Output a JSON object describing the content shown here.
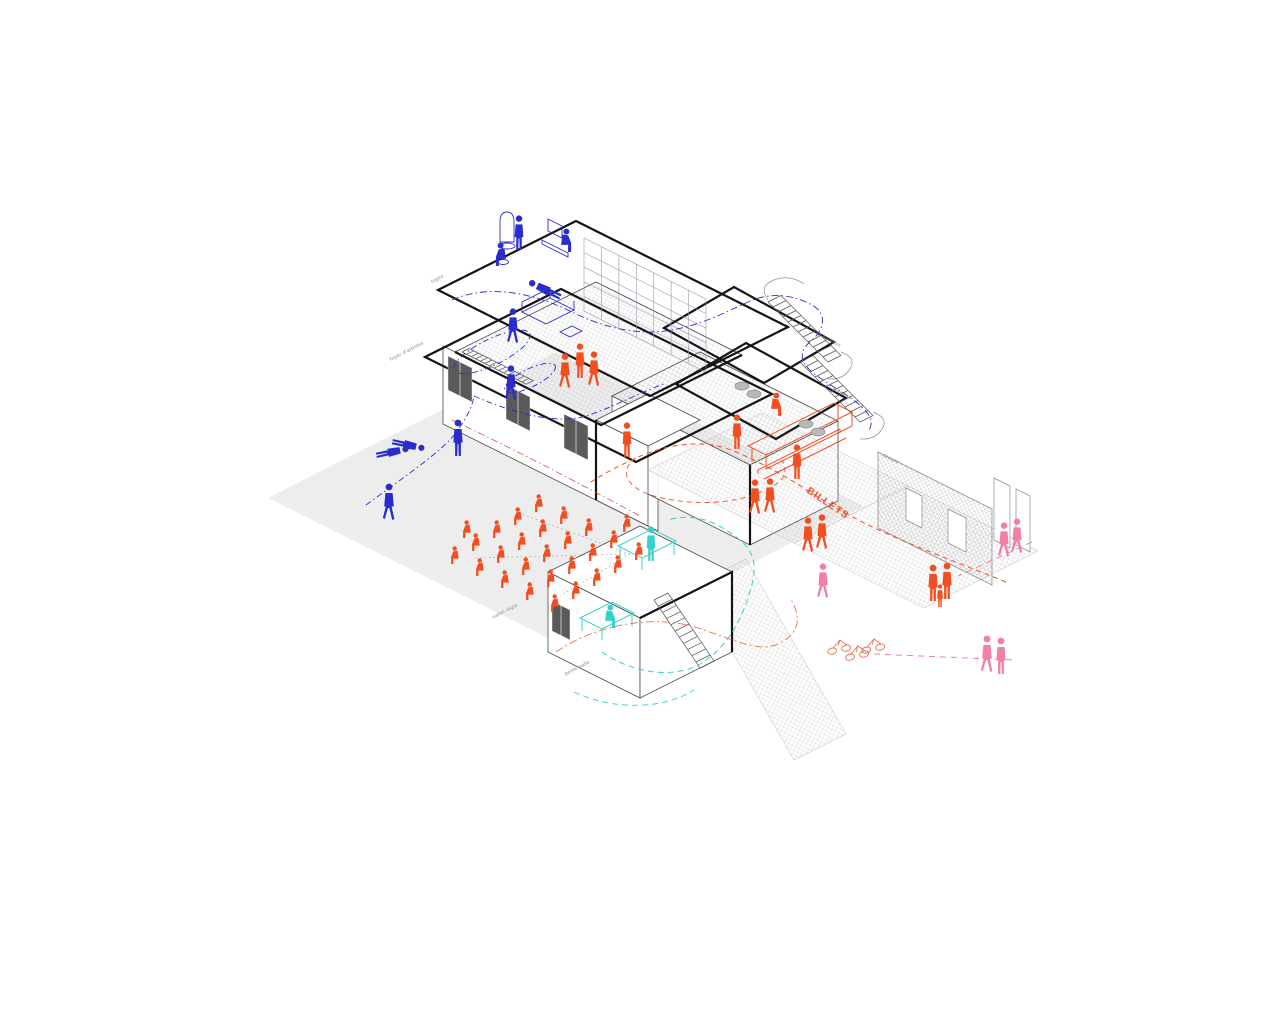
{
  "title": "axonometric circulation diagram of a performance venue",
  "colors": {
    "blue": "#2a2ccd",
    "orange": "#f24e20",
    "orange2": "#e8744f",
    "cyan": "#35d1cd",
    "pink": "#f37fa2",
    "grey_ground": "#ececec",
    "line": "#3c3c3c",
    "thick": "#141414",
    "hatch": "#b9b9b9",
    "label": "#8a8a8a",
    "red": "#e0503a",
    "sight": "#9a9a9a",
    "pouf_fill": "#b9b9b9",
    "pouf_stroke": "#8a8a8a",
    "door_fill": "#5a5a5a"
  },
  "labels": [
    {
      "text": "loges",
      "x": 444,
      "y": 277,
      "rot": -27
    },
    {
      "text": "foyer d'artistes",
      "x": 424,
      "y": 344,
      "rot": -27
    },
    {
      "text": "+2 bureaux",
      "x": 840,
      "y": 347,
      "rot": 27
    },
    {
      "text": "+1 bureaux",
      "x": 850,
      "y": 399,
      "rot": 27
    },
    {
      "text": "accueil",
      "x": 898,
      "y": 464,
      "rot": 27
    },
    {
      "text": "salon régie",
      "x": 518,
      "y": 606,
      "rot": -27
    },
    {
      "text": "petite salle",
      "x": 590,
      "y": 663,
      "rot": -27
    }
  ],
  "billets_label": {
    "text": "BILLETS",
    "x": 806,
    "y": 492,
    "rot": 34,
    "color": "#f24e20"
  },
  "figures": [
    {
      "t": "stand",
      "c": "blue",
      "x": 519,
      "y": 250,
      "s": 0.95
    },
    {
      "t": "sit",
      "c": "blue",
      "x": 562,
      "y": 252,
      "s": 0.95,
      "flip": true
    },
    {
      "t": "sit",
      "c": "blue",
      "x": 505,
      "y": 266,
      "s": 0.95
    },
    {
      "t": "lie",
      "c": "blue",
      "x": 546,
      "y": 306,
      "s": 0.95,
      "rot": -64
    },
    {
      "t": "walk",
      "c": "blue",
      "x": 513,
      "y": 343,
      "s": 0.95
    },
    {
      "t": "walk",
      "c": "blue",
      "x": 511,
      "y": 400,
      "s": 0.95
    },
    {
      "t": "stand",
      "c": "blue",
      "x": 458,
      "y": 456,
      "s": 1
    },
    {
      "t": "lie",
      "c": "blue",
      "x": 392,
      "y": 468,
      "s": 0.9,
      "rot": 78
    },
    {
      "t": "lie",
      "c": "blue",
      "x": 408,
      "y": 461,
      "s": 0.9,
      "rot": 102
    },
    {
      "t": "walk",
      "c": "blue",
      "x": 389,
      "y": 520,
      "s": 1
    },
    {
      "t": "walk",
      "c": "orange",
      "x": 565,
      "y": 388,
      "s": 0.95
    },
    {
      "t": "stand",
      "c": "orange",
      "x": 580,
      "y": 378,
      "s": 0.95
    },
    {
      "t": "walk",
      "c": "orange",
      "x": 594,
      "y": 386,
      "s": 0.95
    },
    {
      "t": "stand",
      "c": "orange",
      "x": 737,
      "y": 449,
      "s": 0.95
    },
    {
      "t": "stand",
      "c": "orange",
      "x": 627,
      "y": 457,
      "s": 0.95
    },
    {
      "t": "walk",
      "c": "orange",
      "x": 755,
      "y": 514,
      "s": 0.95
    },
    {
      "t": "walk",
      "c": "orange",
      "x": 770,
      "y": 513,
      "s": 0.95
    },
    {
      "t": "stand",
      "c": "orange",
      "x": 797,
      "y": 479,
      "s": 0.95
    },
    {
      "t": "sit",
      "c": "orange",
      "x": 772,
      "y": 416,
      "s": 0.95,
      "flip": true
    },
    {
      "t": "walk",
      "c": "orange",
      "x": 808,
      "y": 552,
      "s": 0.95
    },
    {
      "t": "walk",
      "c": "orange",
      "x": 822,
      "y": 549,
      "s": 0.95
    },
    {
      "t": "stand",
      "c": "orange",
      "x": 933,
      "y": 601,
      "s": 1
    },
    {
      "t": "stand",
      "c": "orange",
      "x": 947,
      "y": 599,
      "s": 1
    },
    {
      "t": "stand",
      "c": "orange",
      "x": 940,
      "y": 607,
      "s": 0.62
    },
    {
      "t": "stand",
      "c": "cyan",
      "x": 651,
      "y": 561,
      "s": 0.95
    },
    {
      "t": "sit",
      "c": "cyan",
      "x": 606,
      "y": 628,
      "s": 0.95,
      "flip": true
    },
    {
      "t": "walk",
      "c": "pink",
      "x": 1004,
      "y": 557,
      "s": 0.95
    },
    {
      "t": "walk",
      "c": "pink",
      "x": 1017,
      "y": 553,
      "s": 0.95
    },
    {
      "t": "walk",
      "c": "pink",
      "x": 823,
      "y": 598,
      "s": 0.95
    },
    {
      "t": "walk",
      "c": "pink",
      "x": 987,
      "y": 672,
      "s": 1
    },
    {
      "t": "stand",
      "c": "pink",
      "x": 1001,
      "y": 674,
      "s": 1
    }
  ],
  "audience": {
    "color": "orange",
    "origin": [
      542,
      512
    ],
    "col_step": [
      25,
      12
    ],
    "row_step": [
      -21,
      13
    ],
    "rows": 5,
    "cols": 5,
    "scale": 0.72,
    "extras": [
      [
        470,
        538
      ],
      [
        630,
        532
      ]
    ]
  },
  "paths": [
    {
      "c": "blue",
      "w": 0.9,
      "dash": "7 3 1.5 3",
      "d": "M 452,300 C 492,282 540,296 572,312 S 640,336 672,330 S 726,312 748,302 S 792,294 812,305 C 828,314 824,330 812,340 S 798,360 812,372 C 824,382 844,392 856,402 S 876,420 868,432"
    },
    {
      "c": "blue",
      "w": 0.9,
      "dash": "6 3 1.5 3",
      "d": "M 366,505 C 414,470 446,448 458,430 S 472,406 474,396"
    },
    {
      "c": "blue",
      "w": 0.9,
      "dash": "6 3 1.5 3",
      "d": "M 474,396 C 520,416 560,424 586,416 S 640,392 664,384"
    },
    {
      "c": "orange",
      "w": 1,
      "dash": "5 4",
      "d": "M 1006,582 C 946,558 898,540 866,524 S 810,492 794,482 S 742,452 718,446 C 688,440 658,448 636,458 S 600,476 588,484"
    },
    {
      "c": "orange",
      "w": 0.9,
      "dash": "5 4",
      "d": "M 636,458 C 618,470 626,488 654,496 S 724,506 756,494 S 788,472 782,460"
    },
    {
      "c": "orange2",
      "w": 0.9,
      "dash": "8 3 2 3",
      "d": "M 556,652 C 596,624 656,614 698,628 S 762,654 782,642 S 800,614 790,598"
    },
    {
      "c": "cyan",
      "w": 1,
      "dash": "6 4",
      "d": "M 602,652 C 630,672 672,680 700,664 S 744,616 752,584 S 744,542 726,530 S 688,514 668,520"
    },
    {
      "c": "cyan",
      "w": 0.9,
      "dash": "6 4",
      "d": "M 574,692 C 618,712 666,708 694,690"
    },
    {
      "c": "pink",
      "w": 1,
      "dash": "6 5",
      "d": "M 874,654 L 1014,660"
    },
    {
      "c": "pink",
      "w": 1,
      "dash": "6 5",
      "d": "M 1032,542 L 958,576"
    },
    {
      "c": "sight",
      "w": 0.7,
      "dash": "1.5 3",
      "d": "M 630,554 L 474,558 M 630,554 L 516,512 M 630,554 L 560,596"
    },
    {
      "c": "red",
      "w": 0.8,
      "dash": "7 3 1.5 3",
      "d": "M 452,420 C 520,452 584,486 640,516"
    }
  ],
  "stairs": [
    {
      "x": 768,
      "y": 302,
      "sx": 13,
      "sy": -6.5,
      "dx": 5,
      "dy": 5,
      "n": 12
    },
    {
      "x": 800,
      "y": 362,
      "sx": 13,
      "sy": -6.5,
      "dx": 5,
      "dy": 5,
      "n": 12
    },
    {
      "x": 462,
      "y": 352,
      "sx": 7,
      "sy": -3.5,
      "dx": 4.6,
      "dy": 2.3,
      "n": 14
    },
    {
      "x": 654,
      "y": 600,
      "sx": 14,
      "sy": -7,
      "dx": 4.2,
      "dy": 6.2,
      "n": 11
    }
  ],
  "doors_dark": [
    {
      "x": 448,
      "y": 356,
      "w": 24,
      "h": 34
    },
    {
      "x": 506,
      "y": 385,
      "w": 24,
      "h": 34
    },
    {
      "x": 564,
      "y": 414,
      "w": 24,
      "h": 34
    },
    {
      "x": 552,
      "y": 601,
      "w": 18,
      "h": 30
    }
  ],
  "openings_white": [
    {
      "x": 906,
      "y": 488,
      "w": 16,
      "h": 32
    },
    {
      "x": 948,
      "y": 509,
      "w": 18,
      "h": 34
    },
    {
      "x": 994,
      "y": 478,
      "w": 16,
      "h": 62
    },
    {
      "x": 1016,
      "y": 489,
      "w": 14,
      "h": 56
    }
  ],
  "poufs": [
    [
      742,
      386
    ],
    [
      754,
      394
    ],
    [
      806,
      424
    ],
    [
      818,
      432
    ]
  ],
  "bicycles": [
    [
      840,
      648
    ],
    [
      858,
      654
    ],
    [
      874,
      647
    ]
  ]
}
